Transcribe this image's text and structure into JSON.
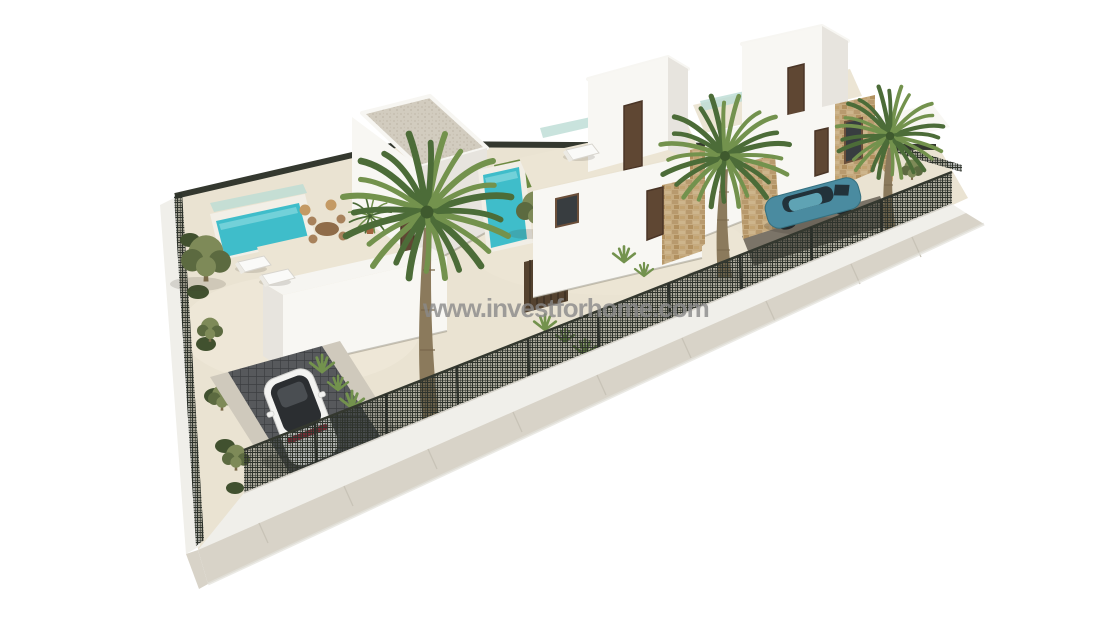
{
  "watermark": {
    "text": "www.investforhome.com"
  },
  "scene": {
    "type": "3d-architectural-render",
    "description": "Aerial 3D render of three modern white flat-roof villas on a triangular walled plot: private turquoise pools, roof terraces with dining set and sun loungers, palm and olive trees, gravel gardens, dark mesh perimeter fence with white base wall, a white car on a dark grid driveway and a teal car in a stone-walled driveway, light sidewalk in front, all on a white background",
    "elements": [
      "villa-left",
      "villa-middle",
      "villa-right",
      "pool-left",
      "pool-middle",
      "lawn-middle",
      "roof-terrace-dining-set",
      "sun-loungers",
      "palm-trees",
      "olive-trees",
      "garden-shrubs",
      "agave-plants",
      "white-car",
      "teal-car",
      "driveway-left",
      "driveway-right",
      "perimeter-fence",
      "back-fence",
      "sidewalk",
      "watermark"
    ],
    "palette": {
      "background": "#ffffff",
      "sand": "#eae3d2",
      "wall-bright": "#f8f7f3",
      "wall-shade": "#e7e4de",
      "roof-gravel": "#d1cbbe",
      "stone": "#c2a87f",
      "pool-water": "#3fbdca",
      "lawn": "#6d8a42",
      "glass": "#bcdcd4",
      "fence-dark": "#34382f",
      "sidewalk": "#d8d3c8",
      "drive-dark": "#55575a",
      "palm-green": "#4c6c38",
      "palm-light": "#73924d",
      "trunk": "#8b7a5c",
      "olive": "#7e8a58",
      "car-white": "#f3f3f1",
      "car-teal": "#4a8ba0",
      "taillight": "#9c2f3e",
      "watermark": "#8a8a8a"
    }
  }
}
